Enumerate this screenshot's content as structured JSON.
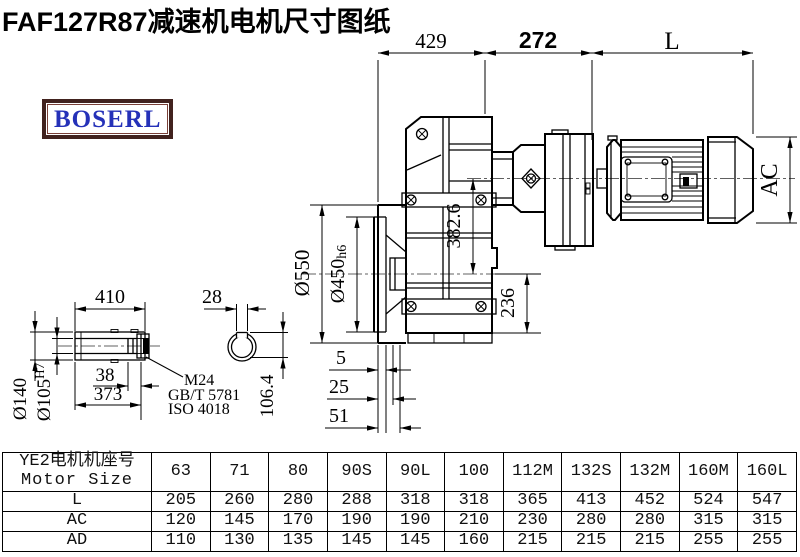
{
  "title": "FAF127R87减速机电机尺寸图纸",
  "logo": {
    "text": "BOSERL"
  },
  "drawing": {
    "dims": {
      "top_left": "429",
      "top_mid": "272",
      "top_right": "L",
      "motor_height": "AC",
      "axis_offset": "382.6",
      "bottom_height": "236",
      "flange_od": "Ø550",
      "spigot_d": "Ø450",
      "spigot_tol": "h6",
      "step1": "5",
      "step2": "25",
      "step3": "51",
      "shaft_len": "410",
      "key_width": "28",
      "bolt_offset": "38",
      "bore_depth": "373",
      "shaft_od": "Ø140",
      "bore_d": "Ø105",
      "bore_tol": "H7",
      "key_height": "106.4",
      "bolt": "M24",
      "bolt_std1": "GB/T 5781",
      "bolt_std2": "ISO 4018"
    }
  },
  "table": {
    "header_cn": "YE2电机机座号",
    "header_en": "Motor Size",
    "sizes": [
      "63",
      "71",
      "80",
      "90S",
      "90L",
      "100",
      "112M",
      "132S",
      "132M",
      "160M",
      "160L"
    ],
    "rows": [
      {
        "label": "L",
        "values": [
          "205",
          "260",
          "280",
          "288",
          "318",
          "318",
          "365",
          "413",
          "452",
          "524",
          "547"
        ]
      },
      {
        "label": "AC",
        "values": [
          "120",
          "145",
          "170",
          "190",
          "190",
          "210",
          "230",
          "280",
          "280",
          "315",
          "315"
        ]
      },
      {
        "label": "AD",
        "values": [
          "110",
          "130",
          "135",
          "145",
          "145",
          "160",
          "215",
          "215",
          "215",
          "255",
          "255"
        ]
      }
    ]
  }
}
